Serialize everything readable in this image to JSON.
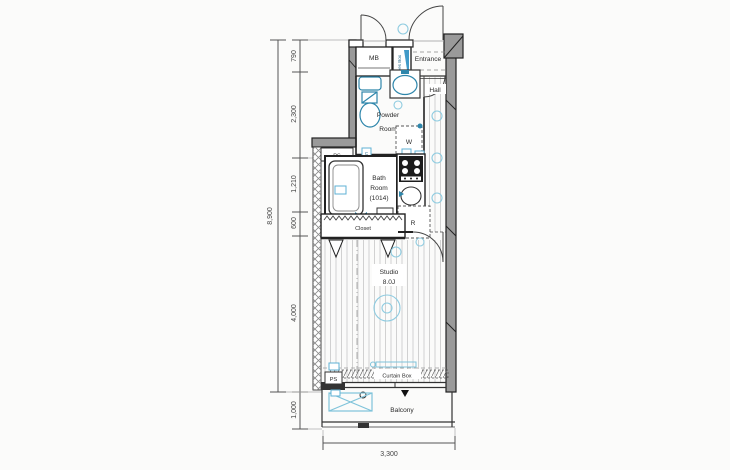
{
  "dimensions": {
    "left_total": "8,900",
    "left_segments": [
      "790",
      "2,300",
      "1,210",
      "600",
      "4,000",
      "1,000"
    ],
    "bottom_width": "3,300"
  },
  "rooms": {
    "mb": "MB",
    "shoes_box": "Shoes Box",
    "entrance": "Entrance",
    "hall": "Hall",
    "powder_line1": "Powder",
    "powder_line2": "Room",
    "washer": "W",
    "bath_line1": "Bath",
    "bath_line2": "Room",
    "bath_line3": "(1014)",
    "closet": "Closet",
    "fridge": "R",
    "studio_line1": "Studio",
    "studio_line2": "8.0J",
    "curtain_box": "Curtain Box",
    "balcony": "Balcony"
  },
  "tags": {
    "ps": "PS",
    "c": "C"
  },
  "colors": {
    "fixture_blue": "#2e86ab",
    "symbol_blue": "#8ecbe0",
    "wall_gray": "#9a9a9a",
    "line_dark": "#222222"
  }
}
